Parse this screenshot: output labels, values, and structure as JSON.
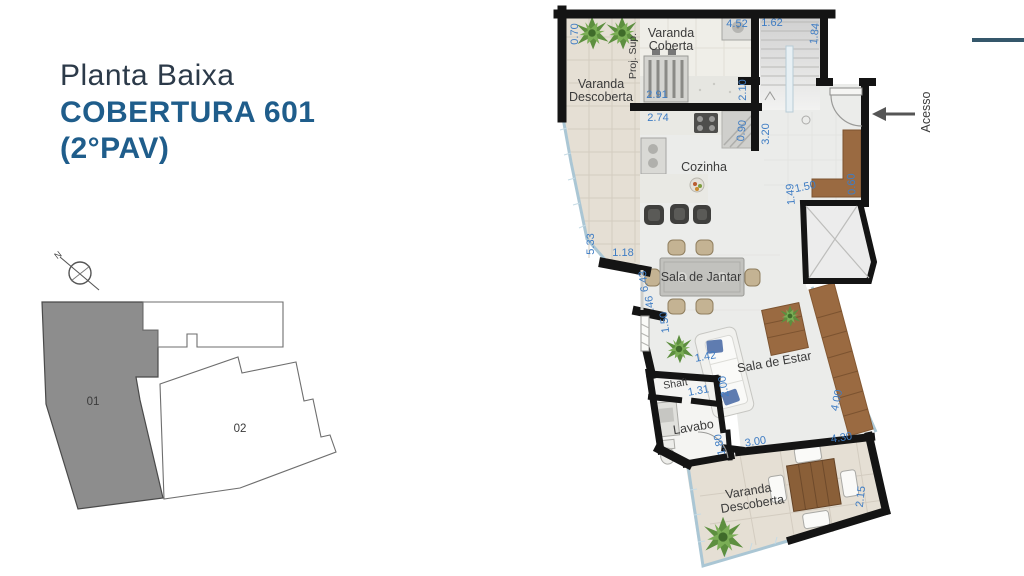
{
  "header": {
    "title": "Planta Baixa",
    "subtitle1": "COBERTURA 601",
    "subtitle2": "(2°PAV)"
  },
  "colors": {
    "title": "#2c3a49",
    "subtitle": "#1f5d8b",
    "dimension_text": "#3f7dc4",
    "room_text": "#3b3b3b",
    "wall": "#141414",
    "accent_line": "#35576b",
    "varanda_floor": "#e5dfd4",
    "interior_floor": "#ebecea",
    "wood": "#9a6a41",
    "keyplan_unit1_fill": "#8d8d8d"
  },
  "keyplan": {
    "north": "N",
    "unit1": "01",
    "unit2": "02"
  },
  "plan": {
    "rooms": {
      "varanda_coberta_1": "Varanda",
      "varanda_coberta_2": "Coberta",
      "varanda_desc_top_1": "Varanda",
      "varanda_desc_top_2": "Descoberta",
      "proj_sup": "Proj. Sup.",
      "cozinha": "Cozinha",
      "jantar": "Sala de Jantar",
      "estar": "Sala de Estar",
      "shaft": "Shaft",
      "lavabo": "Lavabo",
      "varanda_desc_bot_1": "Varanda",
      "varanda_desc_bot_2": "Descoberta",
      "acesso": "Acesso"
    },
    "dims": [
      "0.70",
      "4.52",
      "1.62",
      "1.84",
      "2.91",
      "2.10",
      "2.74",
      "0.90",
      "3.20",
      "5.33",
      "1.18",
      "6.43",
      ".46",
      "1.50",
      "1.49",
      "1.50",
      "0.60",
      "1.42",
      "2.00",
      "1.31",
      "1.80",
      "3.00",
      "4.30",
      "2.15",
      "4.00"
    ]
  }
}
